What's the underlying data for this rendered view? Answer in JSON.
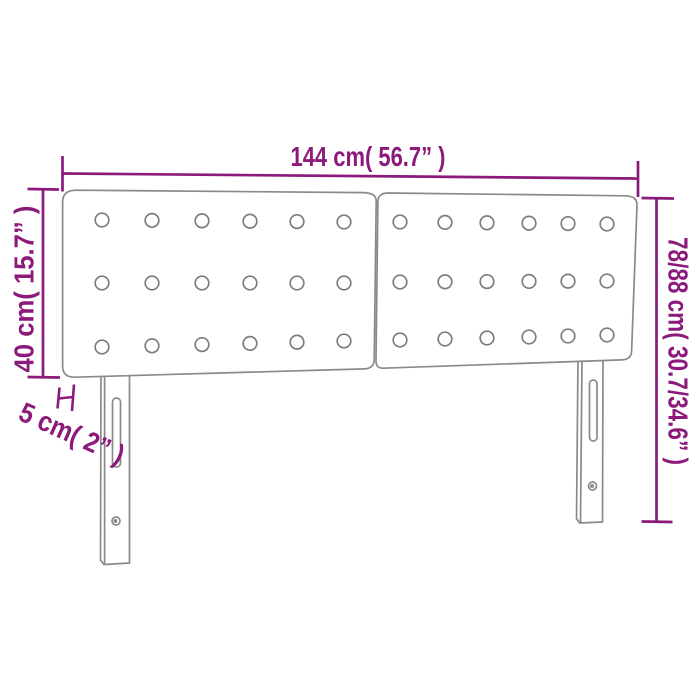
{
  "colors": {
    "dimension": "#8B1A7B",
    "outline": "#8A8A8A",
    "buttons": "#7D7D7D",
    "background": "#FFFFFF"
  },
  "labels": {
    "width": "144 cm( 56.7” )",
    "total_height": "78/88 cm( 30.7/34.6” )",
    "panel_height": "40 cm( 15.7” )",
    "thickness": "5 cm( 2” )"
  },
  "illustration": {
    "subject": "tufted-headboard-front-view",
    "button_radius": 6.8,
    "panels": [
      {
        "cols": [
          102,
          152,
          202,
          250,
          297,
          344
        ],
        "rows": [
          [
            220,
            222
          ],
          [
            283,
            283
          ],
          [
            347,
            341
          ]
        ]
      },
      {
        "cols": [
          400,
          445,
          487,
          529,
          568,
          607
        ],
        "rows": [
          [
            222,
            224
          ],
          [
            282,
            281
          ],
          [
            340,
            335
          ]
        ]
      }
    ]
  }
}
